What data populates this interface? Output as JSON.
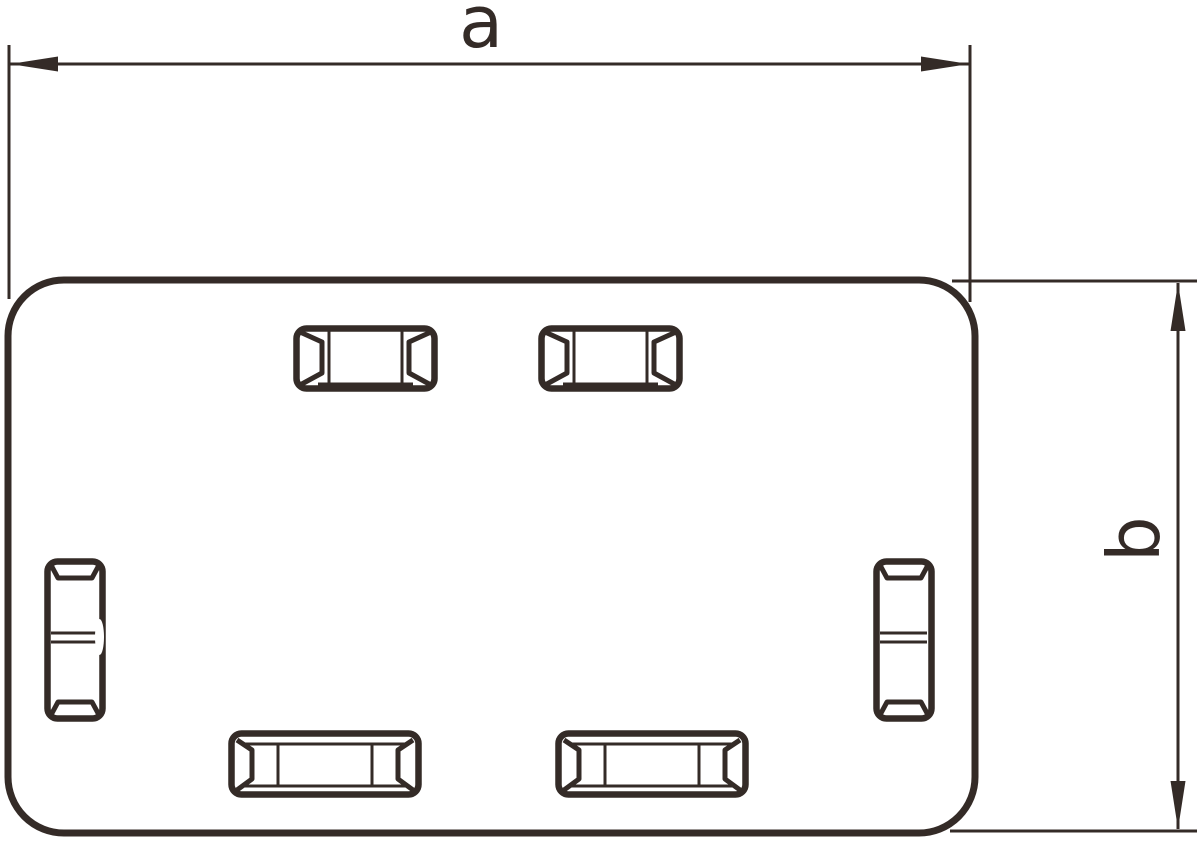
{
  "figure": {
    "type": "technical-dimension-drawing",
    "subject": "rounded rectangular cover plate with beveled knockout slots",
    "dimensions": {
      "width": {
        "label": "a",
        "orientation": "horizontal"
      },
      "height": {
        "label": "b",
        "orientation": "vertical"
      }
    },
    "slot_counts": {
      "top_horizontal_slots": 2,
      "side_vertical_slots": 2,
      "bottom_horizontal_slots": 2
    },
    "colors": {
      "line": "#342b27",
      "background": "#ffffff"
    }
  }
}
